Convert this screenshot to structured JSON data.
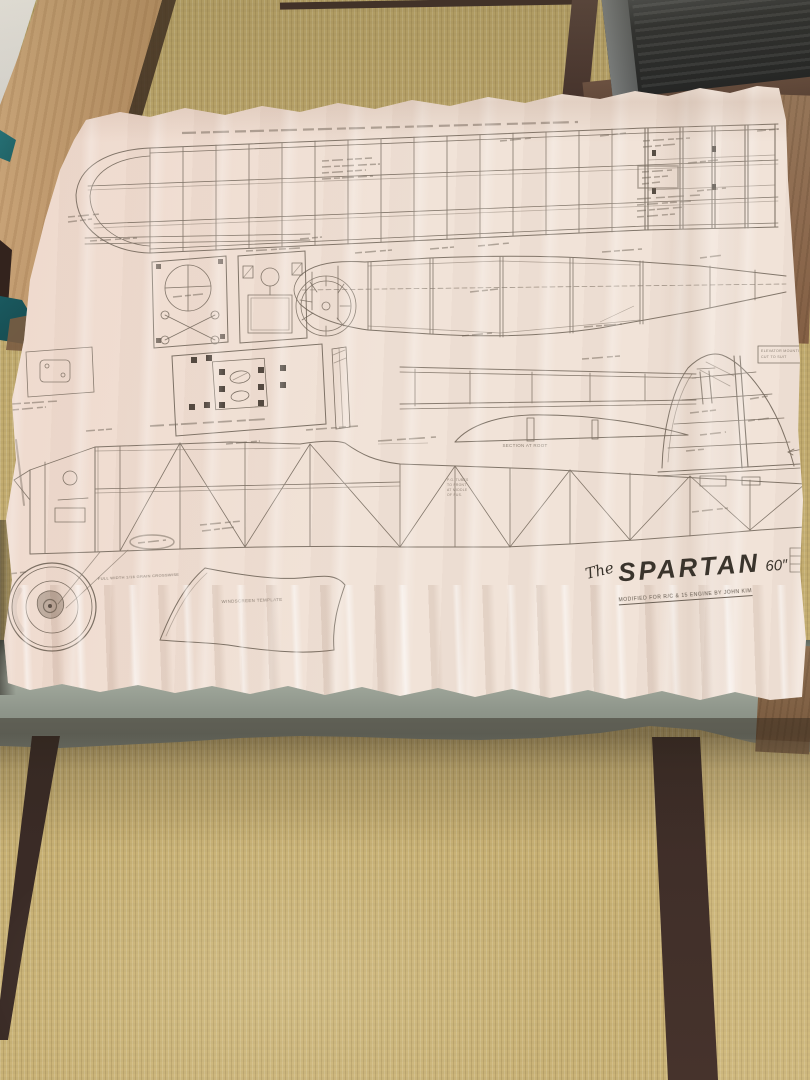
{
  "plan": {
    "title": {
      "prefix": "The",
      "main": "SPARTAN",
      "size": "60″"
    },
    "subtitle": "MODIFIED FOR R/C & 15 ENGINE BY JOHN KIM",
    "labels": {
      "windscreen_template": "WINDSCREEN TEMPLATE",
      "grain_note": "FULL WIDTH 1/16 GRAIN CROSSWISE",
      "root_section": "SECTION AT ROOT",
      "elevator_note_line1": "ELEVATOR MOUNTING",
      "elevator_note_line2": "CUT TO SUIT",
      "pushrod_note": [
        "P.G. TUBES",
        "TO FRONT",
        "AT MIDDLE",
        "OF FUS."
      ]
    }
  },
  "colors": {
    "paper": "#f1e3d8",
    "ink": "#6b6055",
    "title_ink": "#3a342c",
    "tatami": "#c2ab72",
    "mat_border": "#3a2b26",
    "table_cloth": "#99a195",
    "wood_plank": "#c09a6d",
    "cardboard": "#8d6e50",
    "heater_body": "#2b2d2f",
    "teal_box": "#1d5f63",
    "wall": "#e8e6e2"
  }
}
